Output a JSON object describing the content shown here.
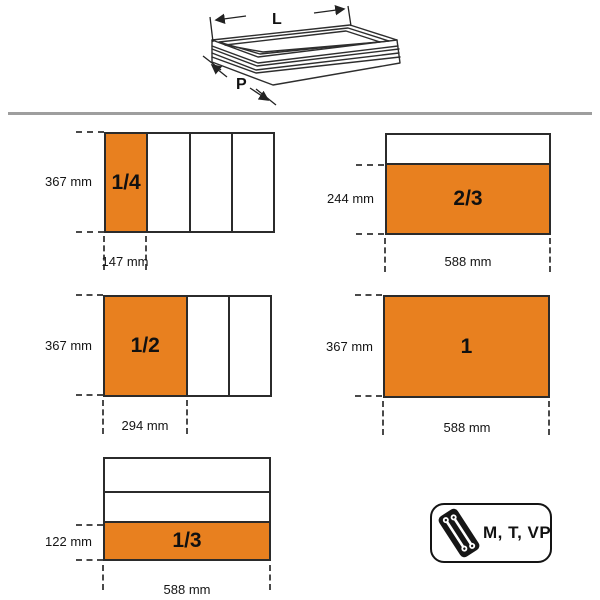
{
  "colors": {
    "accent_orange": "#e8801f",
    "outline": "#2b2b2b",
    "separator_gray": "#9e9e9e"
  },
  "drawer_sketch": {
    "length_label": "L",
    "depth_label": "P"
  },
  "diagrams": [
    {
      "name": "quarter",
      "fraction": "1/4",
      "side_label": "367 mm",
      "bottom_label": "147 mm"
    },
    {
      "name": "two-thirds",
      "fraction": "2/3",
      "side_label": "244 mm",
      "bottom_label": "588 mm"
    },
    {
      "name": "half",
      "fraction": "1/2",
      "side_label": "367 mm",
      "bottom_label": "294 mm"
    },
    {
      "name": "full",
      "fraction": "1",
      "side_label": "367 mm",
      "bottom_label": "588 mm"
    },
    {
      "name": "third",
      "fraction": "1/3",
      "side_label": "122 mm",
      "bottom_label": "588 mm"
    }
  ],
  "badge": {
    "label": "M, T, VP",
    "icon": "tray-wrenches-icon"
  }
}
